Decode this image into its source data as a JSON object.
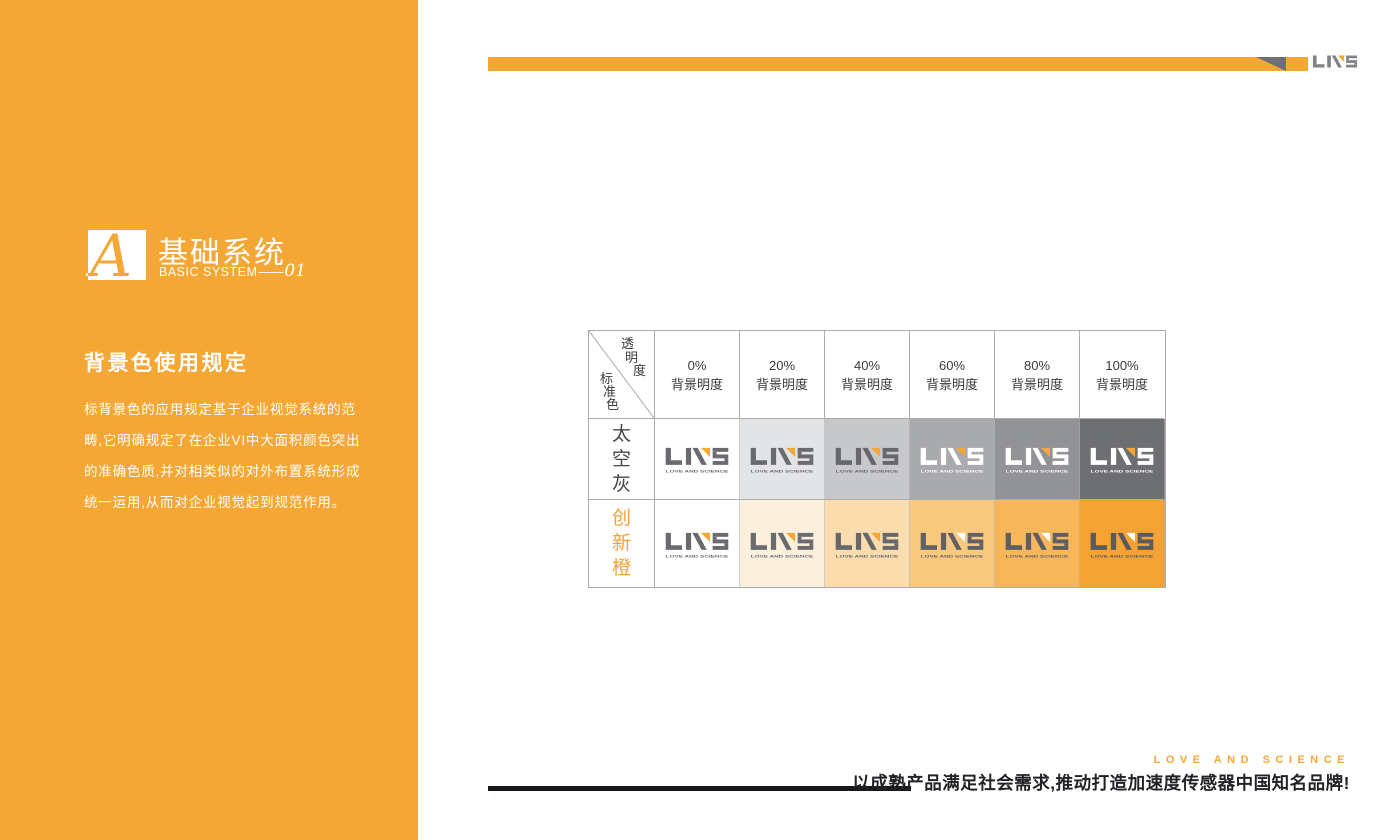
{
  "brand": {
    "orange": "#F5A735",
    "logo_gray": "#6A6B6F",
    "top_logo_gray": "#818286",
    "notch_gray": "#6E6F73",
    "wordmark": "LOVE AND SCIENCE"
  },
  "sidebar": {
    "bg": "#F5A735",
    "logo_letter": "A",
    "title": "基础系统",
    "subtitle": "BASIC SYSTEM",
    "subtitle_dash": "——",
    "section_number": "01",
    "heading": "背景色使用规定",
    "body_lines": [
      "标背景色的应用规定基于企业视觉系统的范",
      "畴,它明确规定了在企业VI中大面积颜色突出",
      "的准确色质,并对相类似的对外布置系统形成",
      "统一运用,从而对企业视觉起到规范作用。"
    ]
  },
  "table": {
    "corner": {
      "top_chars": [
        "透",
        "明",
        "度"
      ],
      "bottom_chars": [
        "标",
        "准",
        "色"
      ]
    },
    "columns": [
      {
        "percent": "0%",
        "label": "背景明度"
      },
      {
        "percent": "20%",
        "label": "背景明度"
      },
      {
        "percent": "40%",
        "label": "背景明度"
      },
      {
        "percent": "60%",
        "label": "背景明度"
      },
      {
        "percent": "80%",
        "label": "背景明度"
      },
      {
        "percent": "100%",
        "label": "背景明度"
      }
    ],
    "rows": [
      {
        "name": "太空灰",
        "label_color": "#46474B",
        "cells": [
          {
            "bg": "#FFFFFF",
            "letters": "#6A6B6F",
            "accent": "#F5A735",
            "word": "#6A6B6F"
          },
          {
            "bg": "#E3E4E6",
            "letters": "#6A6B6F",
            "accent": "#F5A735",
            "word": "#6A6B6F"
          },
          {
            "bg": "#C7C8CA",
            "letters": "#66676B",
            "accent": "#F5A735",
            "word": "#66676B"
          },
          {
            "bg": "#A9AAAD",
            "letters": "#FFFFFF",
            "accent": "#F5A735",
            "word": "#FFFFFF"
          },
          {
            "bg": "#929396",
            "letters": "#FFFFFF",
            "accent": "#F5A735",
            "word": "#FFFFFF"
          },
          {
            "bg": "#6E6F73",
            "letters": "#FFFFFF",
            "accent": "#F5A735",
            "word": "#FFFFFF"
          }
        ]
      },
      {
        "name": "创新橙",
        "label_color": "#F3A233",
        "cells": [
          {
            "bg": "#FFFFFF",
            "letters": "#6A6B6F",
            "accent": "#F5A735",
            "word": "#6A6B6F"
          },
          {
            "bg": "#FCF0DC",
            "letters": "#6A6B6F",
            "accent": "#F5A735",
            "word": "#6A6B6F"
          },
          {
            "bg": "#FBDCAD",
            "letters": "#66676B",
            "accent": "#F3A537",
            "word": "#66676B"
          },
          {
            "bg": "#F9C87F",
            "letters": "#606165",
            "accent": "#FFFFFF",
            "word": "#606165"
          },
          {
            "bg": "#F7B65A",
            "letters": "#5D5E62",
            "accent": "#FFFFFF",
            "word": "#5D5E62"
          },
          {
            "bg": "#F3A233",
            "letters": "#595A5E",
            "accent": "#FFFFFF",
            "word": "#595A5E"
          }
        ]
      }
    ]
  },
  "footer": {
    "tagline_en": "LOVE  AND  SCIENCE",
    "slogan": "以成熟产品满足社会需求,推动打造加速度传感器中国知名品牌!"
  }
}
